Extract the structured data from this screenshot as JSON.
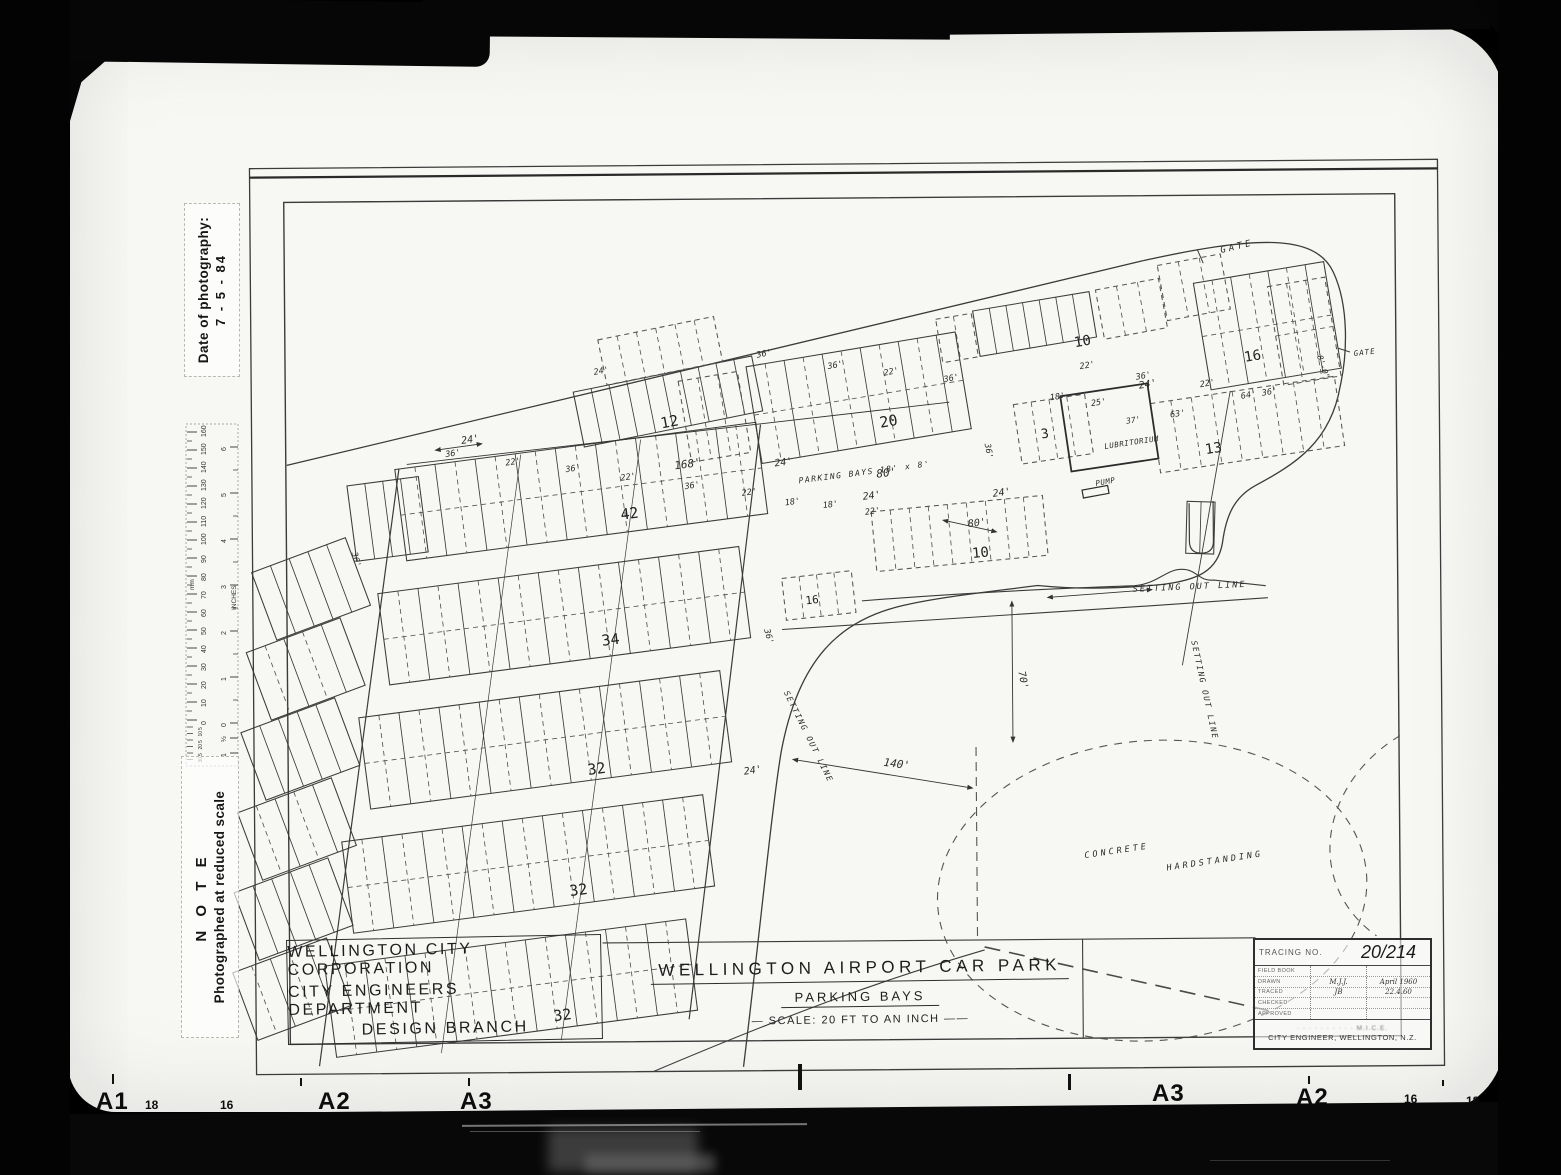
{
  "film": {
    "marks": [
      {
        "t": "A1",
        "x": 96,
        "y": 1088,
        "big": true
      },
      {
        "t": "18",
        "x": 145,
        "y": 1098,
        "big": false
      },
      {
        "t": "16",
        "x": 220,
        "y": 1098,
        "big": false
      },
      {
        "t": "A2",
        "x": 318,
        "y": 1088,
        "big": true
      },
      {
        "t": "A3",
        "x": 460,
        "y": 1088,
        "big": true
      },
      {
        "t": "A3",
        "x": 1152,
        "y": 1080,
        "big": true
      },
      {
        "t": "A2",
        "x": 1296,
        "y": 1084,
        "big": true
      },
      {
        "t": "16",
        "x": 1404,
        "y": 1092,
        "big": false
      },
      {
        "t": "18",
        "x": 1466,
        "y": 1094,
        "big": false
      },
      {
        "t": "A1",
        "x": 1500,
        "y": 1086,
        "big": true
      }
    ]
  },
  "margin_notes": {
    "date_label": "Date of photography:",
    "date_value": "7 - 5 - 84",
    "note_title": "N O T E",
    "note_text": "Photographed at reduced scale",
    "ruler": {
      "unit_mm": "mm",
      "unit_in": "INCHES",
      "mm": [
        "160",
        "150",
        "140",
        "130",
        "120",
        "110",
        "100",
        "90",
        "80",
        "70",
        "60",
        "50",
        "40",
        "30",
        "20",
        "10",
        "0"
      ],
      "mm_sub": [
        "5",
        "10",
        "5",
        "20",
        "5",
        "30"
      ],
      "inches": [
        "6",
        "5",
        "4",
        "3",
        "2",
        "1",
        "0",
        "½",
        "1"
      ]
    }
  },
  "title_block": {
    "corp_lines": [
      "WELLINGTON  CITY  CORPORATION",
      "CITY  ENGINEERS  DEPARTMENT",
      "DESIGN   BRANCH"
    ],
    "main_title": "WELLINGTON   AIRPORT   CAR   PARK",
    "subtitle": "PARKING      BAYS",
    "scale_text": "—  SCALE:  20 FT  TO  AN  INCH  ——",
    "tracing_label": "TRACING  NO.",
    "tracing_number": "20/214",
    "rows": [
      {
        "label": "FIELD BOOK",
        "value": "",
        "date": ""
      },
      {
        "label": "DRAWN",
        "value": "M.J.J.",
        "date": "April 1960"
      },
      {
        "label": "TRACED",
        "value": "JB",
        "date": "22.4.60"
      },
      {
        "label": "CHECKED",
        "value": "",
        "date": ""
      },
      {
        "label": "APPROVED",
        "value": "",
        "date": ""
      }
    ],
    "footer_line1": "· · · · · · · · · ·  M.I.C.E.",
    "footer_line2": "CITY ENGINEER, WELLINGTON, N.Z."
  },
  "plan": {
    "counts": [
      {
        "t": "12",
        "x": 663,
        "y": 427,
        "r": -10,
        "s": 15
      },
      {
        "t": "20",
        "x": 882,
        "y": 428,
        "r": -9,
        "s": 15
      },
      {
        "t": "10",
        "x": 1077,
        "y": 349,
        "r": -9,
        "s": 14
      },
      {
        "t": "16",
        "x": 1247,
        "y": 365,
        "r": -9,
        "s": 14
      },
      {
        "t": "3",
        "x": 1043,
        "y": 440,
        "r": -8,
        "s": 13
      },
      {
        "t": "13",
        "x": 1207,
        "y": 457,
        "r": -8,
        "s": 14
      },
      {
        "t": "42",
        "x": 622,
        "y": 518,
        "r": -7,
        "s": 15
      },
      {
        "t": "10",
        "x": 973,
        "y": 559,
        "r": -5,
        "s": 14
      },
      {
        "t": "16",
        "x": 806,
        "y": 604,
        "r": -6,
        "s": 11
      },
      {
        "t": "34",
        "x": 602,
        "y": 644,
        "r": -7,
        "s": 15
      },
      {
        "t": "32",
        "x": 587,
        "y": 773,
        "r": -7,
        "s": 15
      },
      {
        "t": "32",
        "x": 568,
        "y": 894,
        "r": -7,
        "s": 15
      },
      {
        "t": "32",
        "x": 551,
        "y": 1019,
        "r": -7,
        "s": 15
      }
    ],
    "dims": [
      {
        "t": "24'",
        "x": 463,
        "y": 441,
        "r": -8,
        "s": 10
      },
      {
        "t": "36'",
        "x": 447,
        "y": 454,
        "r": -8,
        "s": 8.5
      },
      {
        "t": "22'",
        "x": 507,
        "y": 463,
        "r": -8,
        "s": 8.5
      },
      {
        "t": "36'",
        "x": 567,
        "y": 470,
        "r": -8,
        "s": 8.5
      },
      {
        "t": "22'",
        "x": 622,
        "y": 479,
        "r": -8,
        "s": 8.5
      },
      {
        "t": "168'",
        "x": 676,
        "y": 468,
        "r": -7,
        "s": 11
      },
      {
        "t": "36'",
        "x": 686,
        "y": 488,
        "r": -8,
        "s": 8.5
      },
      {
        "t": "24'",
        "x": 776,
        "y": 466,
        "r": -7,
        "s": 10
      },
      {
        "t": "80'",
        "x": 878,
        "y": 478,
        "r": -7,
        "s": 11
      },
      {
        "t": "22'",
        "x": 743,
        "y": 495,
        "r": -7,
        "s": 8.5
      },
      {
        "t": "18'",
        "x": 786,
        "y": 505,
        "r": -7,
        "s": 8.5
      },
      {
        "t": "18'",
        "x": 824,
        "y": 508,
        "r": -7,
        "s": 8.5
      },
      {
        "t": "24'",
        "x": 864,
        "y": 500,
        "r": -7,
        "s": 10
      },
      {
        "t": "22'",
        "x": 866,
        "y": 515,
        "r": -7,
        "s": 8.5
      },
      {
        "t": "24'",
        "x": 994,
        "y": 498,
        "r": -7,
        "s": 10
      },
      {
        "t": "80'",
        "x": 969,
        "y": 528,
        "r": -6,
        "s": 10
      },
      {
        "t": "36'",
        "x": 759,
        "y": 357,
        "r": -10,
        "s": 8.5
      },
      {
        "t": "36'",
        "x": 830,
        "y": 369,
        "r": -10,
        "s": 8.5
      },
      {
        "t": "22'",
        "x": 886,
        "y": 376,
        "r": -10,
        "s": 8.5
      },
      {
        "t": "36'",
        "x": 946,
        "y": 383,
        "r": -10,
        "s": 8.5
      },
      {
        "t": "24'",
        "x": 596,
        "y": 373,
        "r": -10,
        "s": 8.5
      },
      {
        "t": "22'",
        "x": 1082,
        "y": 371,
        "r": -9,
        "s": 8.5
      },
      {
        "t": "36'",
        "x": 1138,
        "y": 382,
        "r": -9,
        "s": 8.5
      },
      {
        "t": "24'",
        "x": 1141,
        "y": 391,
        "r": -9,
        "s": 10
      },
      {
        "t": "22'",
        "x": 1202,
        "y": 390,
        "r": -9,
        "s": 8.5
      },
      {
        "t": "64'",
        "x": 1243,
        "y": 402,
        "r": -9,
        "s": 8.5
      },
      {
        "t": "36'",
        "x": 1264,
        "y": 399,
        "r": -9,
        "s": 8.5
      },
      {
        "t": "18'",
        "x": 1052,
        "y": 402,
        "r": -8,
        "s": 8.5
      },
      {
        "t": "25'",
        "x": 1093,
        "y": 408,
        "r": -8,
        "s": 8.5
      },
      {
        "t": "37'",
        "x": 1128,
        "y": 426,
        "r": -8,
        "s": 8
      },
      {
        "t": "63'",
        "x": 1172,
        "y": 420,
        "r": -8,
        "s": 8.5
      },
      {
        "t": "36'",
        "x": 986,
        "y": 445,
        "r": 80,
        "s": 8.5
      },
      {
        "t": "8'-0\"",
        "x": 1319,
        "y": 360,
        "r": 72,
        "s": 8
      },
      {
        "t": "140'",
        "x": 882,
        "y": 766,
        "r": 8,
        "s": 11
      },
      {
        "t": "70'",
        "x": 1018,
        "y": 673,
        "r": 80,
        "s": 10
      },
      {
        "t": "24'",
        "x": 743,
        "y": 774,
        "r": -8,
        "s": 10
      },
      {
        "t": "36'",
        "x": 764,
        "y": 629,
        "r": 75,
        "s": 8.5
      },
      {
        "t": "36'",
        "x": 352,
        "y": 549,
        "r": 75,
        "s": 8.5
      }
    ],
    "texts": [
      {
        "t": "GATE",
        "x": 1224,
        "y": 256,
        "r": -13,
        "s": 9,
        "ls": 3
      },
      {
        "t": "GATE",
        "x": 1356,
        "y": 360,
        "r": -6,
        "s": 7.5,
        "ls": 1
      },
      {
        "t": "LUBRITORIUM",
        "x": 1106,
        "y": 451,
        "r": -8,
        "s": 7.5,
        "ls": 0.5
      },
      {
        "t": "PUMP",
        "x": 1097,
        "y": 488,
        "r": -10,
        "s": 7.5,
        "ls": 0.5
      },
      {
        "t": "SETTING   OUT   LINE",
        "x": 1133,
        "y": 594,
        "r": -2,
        "s": 8.5,
        "ls": 2
      },
      {
        "t": "SETTING  OUT  LINE",
        "x": 1191,
        "y": 644,
        "r": 78,
        "s": 8,
        "ls": 1.5
      },
      {
        "t": "SETTING  OUT  LINE",
        "x": 783,
        "y": 692,
        "r": 64,
        "s": 8,
        "ls": 1.5
      },
      {
        "t": "CONCRETE",
        "x": 1083,
        "y": 860,
        "r": -8,
        "s": 8.5,
        "ls": 3
      },
      {
        "t": "HARDSTANDING",
        "x": 1165,
        "y": 873,
        "r": -8,
        "s": 8.5,
        "ls": 3
      },
      {
        "t": "PARKING   BAYS   18' x 8'",
        "x": 800,
        "y": 483,
        "r": -7,
        "s": 8,
        "ls": 1.5
      }
    ]
  }
}
